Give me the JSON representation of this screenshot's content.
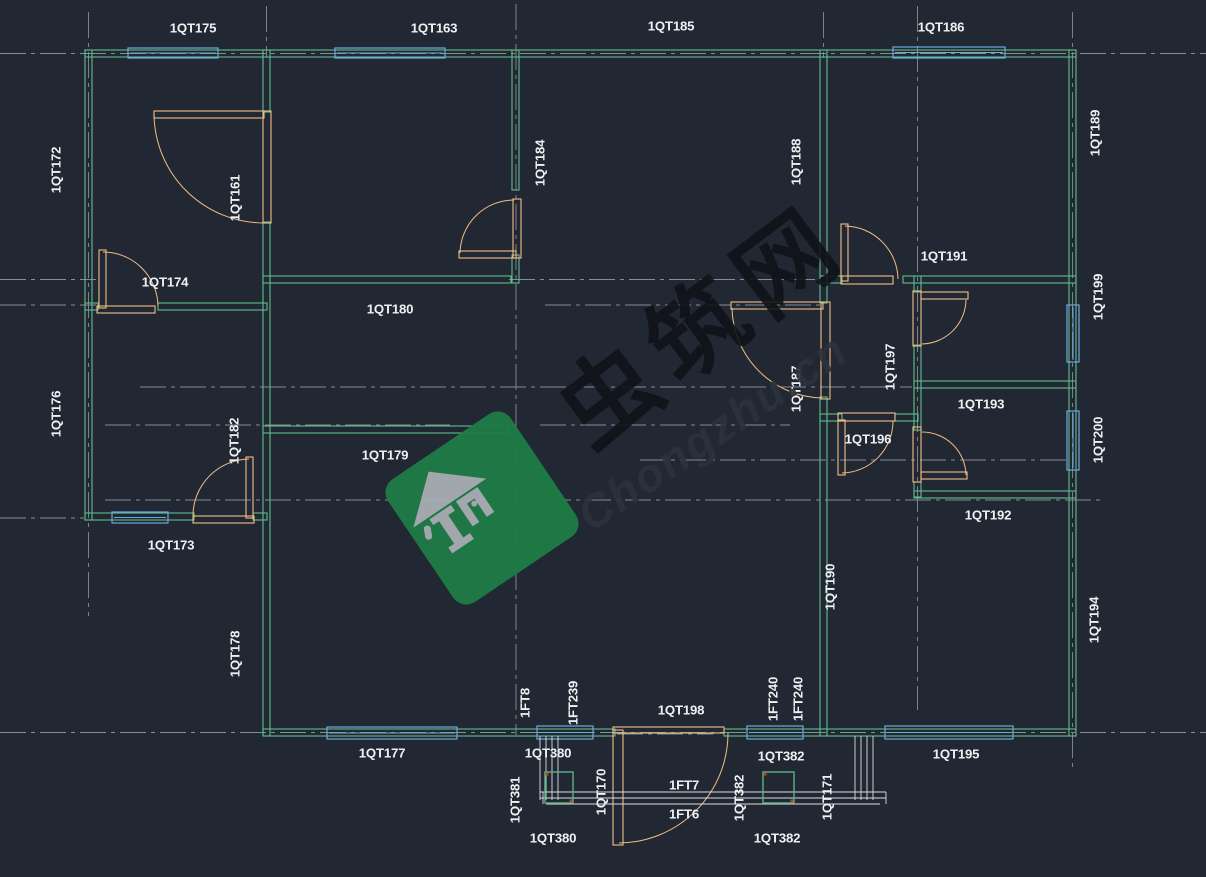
{
  "canvas": {
    "width": 1206,
    "height": 877,
    "background": "#222833"
  },
  "colors": {
    "wall": "#5cbd8a",
    "window": "#6fa8e0",
    "door": "#f0bd85",
    "grid": "#878d95",
    "text": "#eef1f3",
    "step": "#d9dde1",
    "post": "#58b380",
    "dot": "#c03a32"
  },
  "drawing": {
    "grid_h": [
      [
        53.5,
        0,
        1206
      ],
      [
        279.5,
        0,
        96
      ],
      [
        279.5,
        509,
        820
      ],
      [
        305,
        0,
        96
      ],
      [
        305,
        545,
        820
      ],
      [
        387,
        140,
        912
      ],
      [
        425,
        105,
        450
      ],
      [
        425,
        540,
        790
      ],
      [
        460,
        640,
        1070
      ],
      [
        500,
        105,
        1100
      ],
      [
        518,
        0,
        84
      ],
      [
        732.5,
        0,
        1206
      ],
      [
        734,
        617,
        713
      ]
    ],
    "grid_v": [
      [
        88.5,
        12,
        616
      ],
      [
        266.5,
        6,
        58
      ],
      [
        516,
        4,
        735
      ],
      [
        823.5,
        12,
        58
      ],
      [
        917.5,
        6,
        710
      ],
      [
        1072.5,
        12,
        768
      ]
    ],
    "walls": [
      [
        85,
        50,
        991,
        7
      ],
      [
        85,
        50,
        7,
        470
      ],
      [
        85,
        513,
        109,
        7
      ],
      [
        253,
        513,
        14,
        7
      ],
      [
        263,
        50,
        7,
        62
      ],
      [
        263,
        222,
        7,
        514
      ],
      [
        263,
        729,
        352,
        7
      ],
      [
        724,
        729,
        352,
        7
      ],
      [
        1069,
        50,
        7,
        686
      ],
      [
        263,
        276,
        248,
        7
      ],
      [
        512,
        50,
        7,
        140
      ],
      [
        512,
        255,
        7,
        28
      ],
      [
        263,
        426,
        246,
        7
      ],
      [
        85,
        303,
        13,
        7
      ],
      [
        158,
        303,
        109,
        7
      ],
      [
        820,
        50,
        7,
        253
      ],
      [
        820,
        397,
        7,
        339
      ],
      [
        820,
        276,
        22,
        7
      ],
      [
        903,
        276,
        173,
        7
      ],
      [
        914,
        276,
        7,
        16
      ],
      [
        914,
        345,
        7,
        85
      ],
      [
        914,
        482,
        7,
        15
      ],
      [
        914,
        381,
        162,
        7
      ],
      [
        914,
        491,
        162,
        7
      ],
      [
        820,
        414,
        22,
        7
      ],
      [
        895,
        414,
        23,
        7
      ]
    ],
    "windows": [
      [
        128,
        48,
        90,
        10
      ],
      [
        335,
        48,
        110,
        10
      ],
      [
        893,
        47,
        112,
        11
      ],
      [
        112,
        512,
        56,
        11
      ],
      [
        1067,
        305,
        12,
        57
      ],
      [
        1067,
        411,
        12,
        59
      ],
      [
        327,
        727,
        130,
        12
      ],
      [
        537,
        726,
        56,
        13
      ],
      [
        747,
        726,
        56,
        13
      ],
      [
        885,
        726,
        128,
        13
      ]
    ],
    "door_bars": [
      [
        154,
        111,
        110,
        7
      ],
      [
        263,
        111,
        8,
        112
      ],
      [
        99,
        250,
        7,
        58
      ],
      [
        97,
        306,
        58,
        7
      ],
      [
        459,
        251,
        57,
        7
      ],
      [
        513,
        199,
        8,
        59
      ],
      [
        246,
        457,
        7,
        61
      ],
      [
        193,
        516,
        61,
        7
      ],
      [
        731,
        302,
        92,
        7
      ],
      [
        821,
        302,
        9,
        97
      ],
      [
        921,
        292,
        47,
        7
      ],
      [
        913,
        291,
        8,
        55
      ],
      [
        921,
        472,
        46,
        7
      ],
      [
        913,
        427,
        8,
        55
      ],
      [
        841,
        224,
        7,
        57
      ],
      [
        841,
        276,
        52,
        8
      ],
      [
        838,
        420,
        7,
        55
      ],
      [
        838,
        413,
        57,
        8
      ],
      [
        613,
        730,
        10,
        115
      ],
      [
        613,
        727,
        111,
        6
      ]
    ],
    "door_arcs": [
      "M154,114 A110,110 0 0 0 263,223",
      "M103,252 A55,55 0 0 1 158,306",
      "M460,253 A54,54 0 0 1 514,200",
      "M249,459 A57,57 0 0 0 193,516",
      "M732,308 A92,92 0 0 0 822,398",
      "M966,300 A45,45 0 0 1 922,344",
      "M922,432 A44,44 0 0 1 966,475",
      "M845,226 A54,54 0 0 1 898,279",
      "M842,473 A52,52 0 0 0 893,421",
      "M619,843 A110,110 0 0 0 728,733"
    ],
    "steps_h": [
      [
        792,
        540,
        886
      ],
      [
        798,
        540,
        886
      ],
      [
        804,
        546,
        880
      ]
    ],
    "steps_v": [
      [
        540,
        736,
        800
      ],
      [
        546,
        736,
        800
      ],
      [
        552,
        736,
        800
      ],
      [
        558,
        736,
        800
      ],
      [
        855,
        736,
        800
      ],
      [
        861,
        736,
        800
      ],
      [
        867,
        736,
        800
      ],
      [
        873,
        736,
        800
      ],
      [
        886,
        792,
        804
      ],
      [
        543,
        792,
        804
      ]
    ],
    "posts": [
      [
        545,
        772,
        28,
        31
      ],
      [
        763,
        772,
        31,
        31
      ]
    ],
    "dots": [
      [
        547,
        774
      ],
      [
        571,
        801
      ],
      [
        765,
        774
      ],
      [
        792,
        801
      ]
    ]
  },
  "labels": [
    {
      "t": "1QT175",
      "x": 193,
      "y": 29,
      "r": 0
    },
    {
      "t": "1QT163",
      "x": 434,
      "y": 29,
      "r": 0
    },
    {
      "t": "1QT185",
      "x": 671,
      "y": 27,
      "r": 0
    },
    {
      "t": "1QT186",
      "x": 941,
      "y": 28,
      "r": 0
    },
    {
      "t": "1QT174",
      "x": 165,
      "y": 283,
      "r": 0
    },
    {
      "t": "1QT180",
      "x": 390,
      "y": 310,
      "r": 0
    },
    {
      "t": "1QT191",
      "x": 944,
      "y": 257,
      "r": 0
    },
    {
      "t": "1QT193",
      "x": 981,
      "y": 405,
      "r": 0
    },
    {
      "t": "1QT196",
      "x": 868,
      "y": 440,
      "r": 0
    },
    {
      "t": "1QT179",
      "x": 385,
      "y": 456,
      "r": 0
    },
    {
      "t": "1QT192",
      "x": 988,
      "y": 516,
      "r": 0
    },
    {
      "t": "1QT173",
      "x": 171,
      "y": 546,
      "r": 0
    },
    {
      "t": "1QT177",
      "x": 382,
      "y": 754,
      "r": 0
    },
    {
      "t": "1QT198",
      "x": 681,
      "y": 711,
      "r": 0
    },
    {
      "t": "1QT380",
      "x": 548,
      "y": 754,
      "r": 0
    },
    {
      "t": "1QT380",
      "x": 553,
      "y": 839,
      "r": 0
    },
    {
      "t": "1FT7",
      "x": 684,
      "y": 786,
      "r": 0
    },
    {
      "t": "1FT6",
      "x": 684,
      "y": 815,
      "r": 0
    },
    {
      "t": "1QT382",
      "x": 781,
      "y": 757,
      "r": 0
    },
    {
      "t": "1QT382",
      "x": 777,
      "y": 839,
      "r": 0
    },
    {
      "t": "1QT195",
      "x": 956,
      "y": 755,
      "r": 0
    },
    {
      "t": "1QT172",
      "x": 57,
      "y": 170,
      "r": -90
    },
    {
      "t": "1QT176",
      "x": 57,
      "y": 414,
      "r": -90
    },
    {
      "t": "1QT161",
      "x": 236,
      "y": 198,
      "r": -90
    },
    {
      "t": "1QT184",
      "x": 541,
      "y": 163,
      "r": -90
    },
    {
      "t": "1QT188",
      "x": 797,
      "y": 162,
      "r": -90
    },
    {
      "t": "1QT189",
      "x": 1096,
      "y": 133,
      "r": -90
    },
    {
      "t": "1QT199",
      "x": 1099,
      "y": 297,
      "r": -90
    },
    {
      "t": "1QT200",
      "x": 1099,
      "y": 440,
      "r": -90
    },
    {
      "t": "1QT197",
      "x": 891,
      "y": 367,
      "r": -90
    },
    {
      "t": "1QT187",
      "x": 797,
      "y": 389,
      "r": -90
    },
    {
      "t": "1QT182",
      "x": 235,
      "y": 441,
      "r": -90
    },
    {
      "t": "1QT190",
      "x": 831,
      "y": 587,
      "r": -90
    },
    {
      "t": "1QT178",
      "x": 236,
      "y": 654,
      "r": -90
    },
    {
      "t": "1QT194",
      "x": 1095,
      "y": 620,
      "r": -90
    },
    {
      "t": "1FT8",
      "x": 526,
      "y": 703,
      "r": -90
    },
    {
      "t": "1FT239",
      "x": 574,
      "y": 703,
      "r": -90
    },
    {
      "t": "1FT240",
      "x": 774,
      "y": 699,
      "r": -90
    },
    {
      "t": "1FT240",
      "x": 799,
      "y": 699,
      "r": -90
    },
    {
      "t": "1QT381",
      "x": 516,
      "y": 800,
      "r": -90
    },
    {
      "t": "1QT170",
      "x": 602,
      "y": 792,
      "r": -90
    },
    {
      "t": "1QT382",
      "x": 740,
      "y": 798,
      "r": -90
    },
    {
      "t": "1QT171",
      "x": 828,
      "y": 797,
      "r": -90
    }
  ],
  "watermark": {
    "chars": "虫筑网",
    "sub": "Chongzhu.cn",
    "diamond_color": "#1e7c46",
    "house_color": "#a8aeb4",
    "chars_color": "#101419",
    "sub_color": "#2b323c",
    "diamond_center_x": 482,
    "diamond_center_y": 508,
    "diamond_size": 148,
    "rotation_deg": -34
  }
}
